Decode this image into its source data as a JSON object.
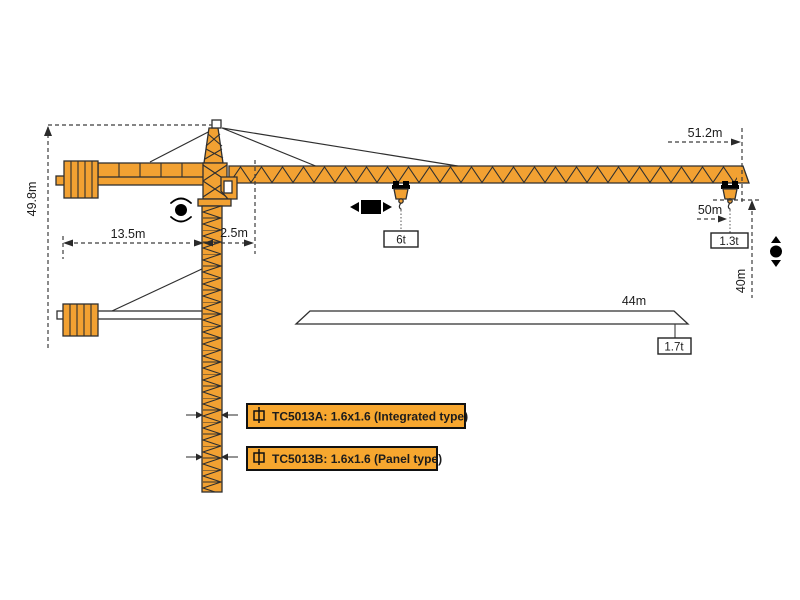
{
  "colors": {
    "crane_orange": "#F2A132",
    "label_box_orange": "#F7A72F",
    "line_dark": "#2F2F2F"
  },
  "dimensions": {
    "total_height": "49.8m",
    "counter_jib_length": "13.5m",
    "slew_offset": "2.5m",
    "max_jib_radius": "51.2m",
    "hook_radius": "50m",
    "lower_hook_height": "40m",
    "short_jib_length": "44m"
  },
  "loads": {
    "mid_span": "6t",
    "jib_tip": "1.3t",
    "short_jib_tip": "1.7t"
  },
  "variants": [
    {
      "label": "TC5013A: 1.6x1.6 (Integrated type)"
    },
    {
      "label": "TC5013B: 1.6x1.6 (Panel type)"
    }
  ]
}
